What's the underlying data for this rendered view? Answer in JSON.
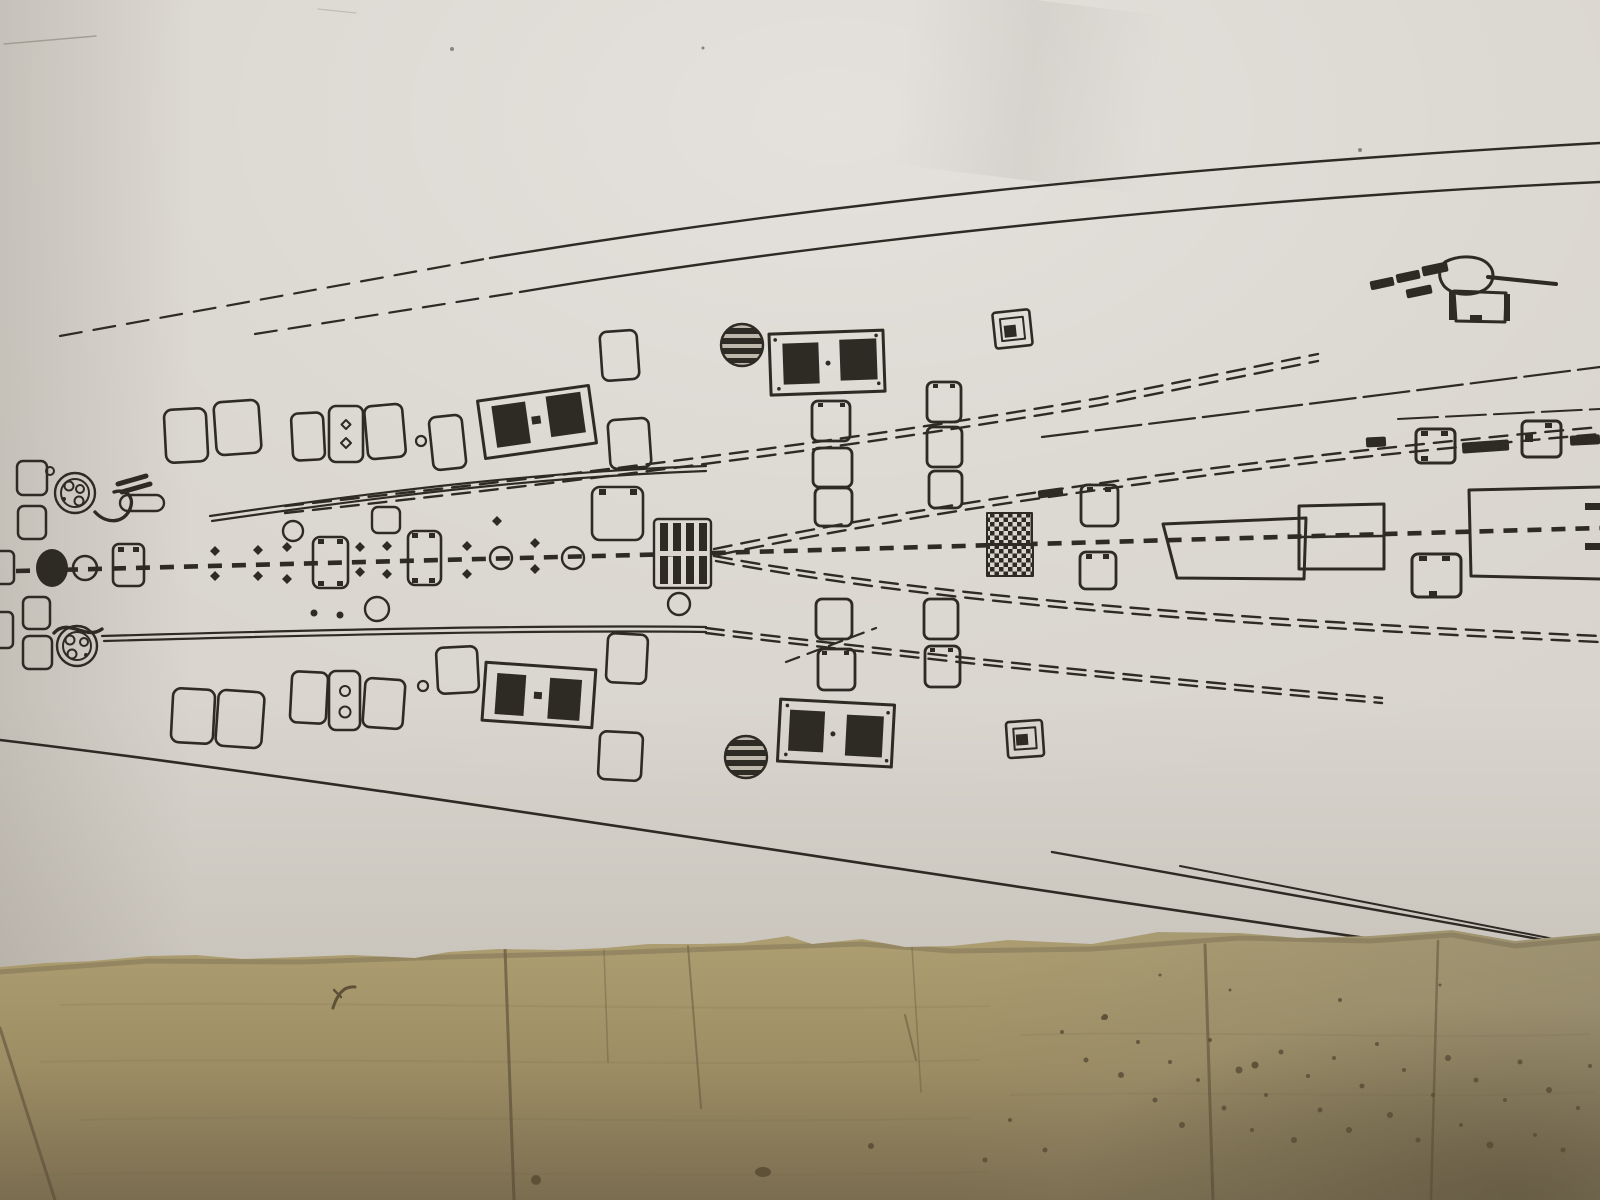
{
  "scene": {
    "description": "Photograph of a black-and-white printed model-ship deck plan sheet lying on a wooden plank table",
    "sheet": "ship deck plan blueprint, top view, bow pointing right",
    "surface": "wooden planks, darker and speckled toward bottom right"
  },
  "colors": {
    "paper_base": "#d9d5ce",
    "paper_bright": "#ffffff",
    "paper_edge_shade": "#8a8173",
    "ink": "#2e2a24",
    "vent_gray": "#bdb7ac",
    "wood_top": "#b2a375",
    "wood_mid": "#9c8d64",
    "wood_bottom": "#7a6d50",
    "plank_line": "#4f4430",
    "speckle": "#564b36",
    "stain": "#5f5138",
    "shadow": "#6a5f49"
  },
  "plan": {
    "parts": [
      "hull sheer lines",
      "dashed deck centerline",
      "stern capstan",
      "mooring winches",
      "deck hatch rows",
      "twin-panel skylights",
      "striped ventilators",
      "slatted skylight",
      "checkered gratings",
      "hatch pairs on diagonal walkways",
      "bow deckhouse blocks",
      "stockless anchor with chain links",
      "open bow platform"
    ]
  }
}
